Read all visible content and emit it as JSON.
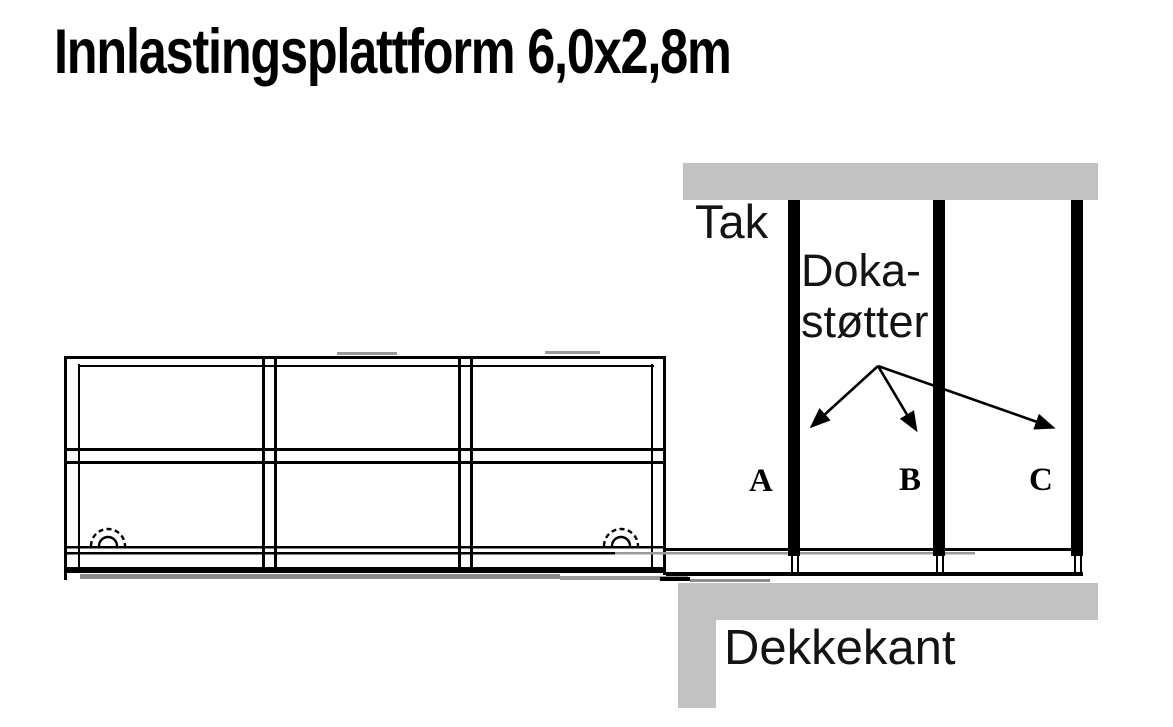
{
  "title": "Innlastingsplattform 6,0x2,8m",
  "labels": {
    "roof": "Tak",
    "doka_line1": "Doka-",
    "doka_line2": "støtter",
    "deck_edge": "Dekkekant",
    "prop_a": "A",
    "prop_b": "B",
    "prop_c": "C"
  },
  "colors": {
    "slab_gray": "#c2c2c2",
    "shadow_dark_gray": "#8c8c8c",
    "shadow_mid_gray": "#9a9a9a",
    "ink": "#000000"
  },
  "diagram": {
    "type": "construction-elevation",
    "platform": {
      "name": "innlastingsplattform",
      "size_label": "6,0x2,8m",
      "bays": 3,
      "levels": 2,
      "wheels": 2
    },
    "props": [
      {
        "id": "A"
      },
      {
        "id": "B"
      },
      {
        "id": "C"
      }
    ],
    "roof_slab": "Tak",
    "slab_edge": "Dekkekant"
  }
}
